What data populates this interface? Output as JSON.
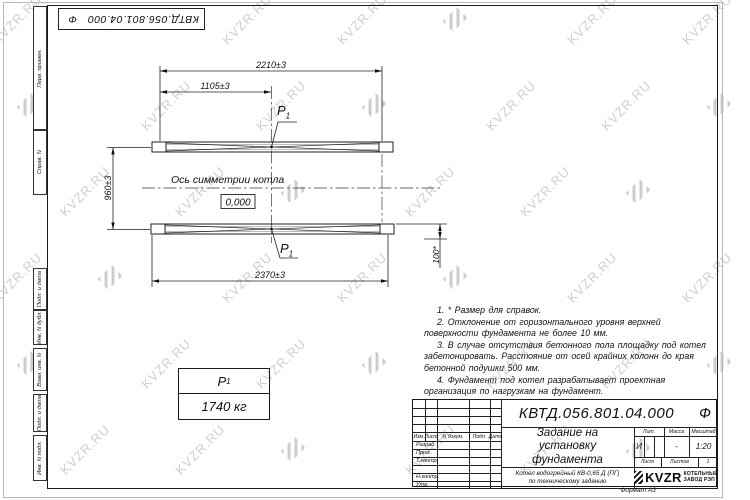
{
  "watermark": {
    "text": "KVZR.RU"
  },
  "stamp": {
    "code": "КВТД.056.801.04.000",
    "suffix": "Ф"
  },
  "margin_labels": {
    "perv": "Перв. примен.",
    "sprav": "Справ. N",
    "podp1": "Подп. и дата",
    "inv_dubl": "Инв. N дубл.",
    "vzam": "Взам. инв. N",
    "podp2": "Подп. и дата",
    "inv_podl": "Инв. N подл."
  },
  "drawing": {
    "dim_2210": "2210±3",
    "dim_1105": "1105±3",
    "dim_960": "960±3",
    "dim_2370": "2370±3",
    "dim_100": "100*",
    "axis_label": "Ось симметрии котла",
    "level_mark": "0,000",
    "load_base": "P",
    "load_sub": "1"
  },
  "load_table": {
    "name_base": "Р",
    "name_sub": "1",
    "value": "1740 кг"
  },
  "notes": [
    "1. * Размер для справок.",
    "2. Отклонение от горизонтального уровня верхней поверхности фундамента не более 10 мм.",
    "3. В случае отсутствия бетонного пола площадку под котел забетонировать. Расстояние от осей крайних колонн до края бетонной подушки 500 мм.",
    "4. Фундамент под котел разрабатывает проектная организация по нагрузкам на фундамент."
  ],
  "title_block": {
    "doc_code": "КВТД.056.801.04.000",
    "doc_suffix": "Ф",
    "title_line1": "Задание на",
    "title_line2": "установку",
    "title_line3": "фундамента",
    "product_line1": "Котел водогрейный КВ-0,65 Д (ПГ)",
    "product_line2": "по техническому заданию",
    "cols": {
      "izm": "Изм.",
      "list": "Лист",
      "ndoc": "N докум.",
      "podp": "Подп.",
      "data": "Дата"
    },
    "rows": {
      "razrab": "Разраб.",
      "prov": "Пров.",
      "tkontr": "Т.контр.",
      "nkontr": "Н.контр.",
      "utv": "Утв."
    },
    "lit_header": "Лит.",
    "mass_header": "Масса",
    "scale_header": "Масштаб",
    "lit": "И",
    "mass": "-",
    "scale": "1:20",
    "sheet_label": "Лист",
    "sheets_label": "Листов",
    "sheets_total": "1",
    "logo_text": "KVZR",
    "logo_sub1": "КОТЕЛЬНЫЙ",
    "logo_sub2": "ЗАВОД РЭП"
  },
  "format_label": "Формат А3"
}
